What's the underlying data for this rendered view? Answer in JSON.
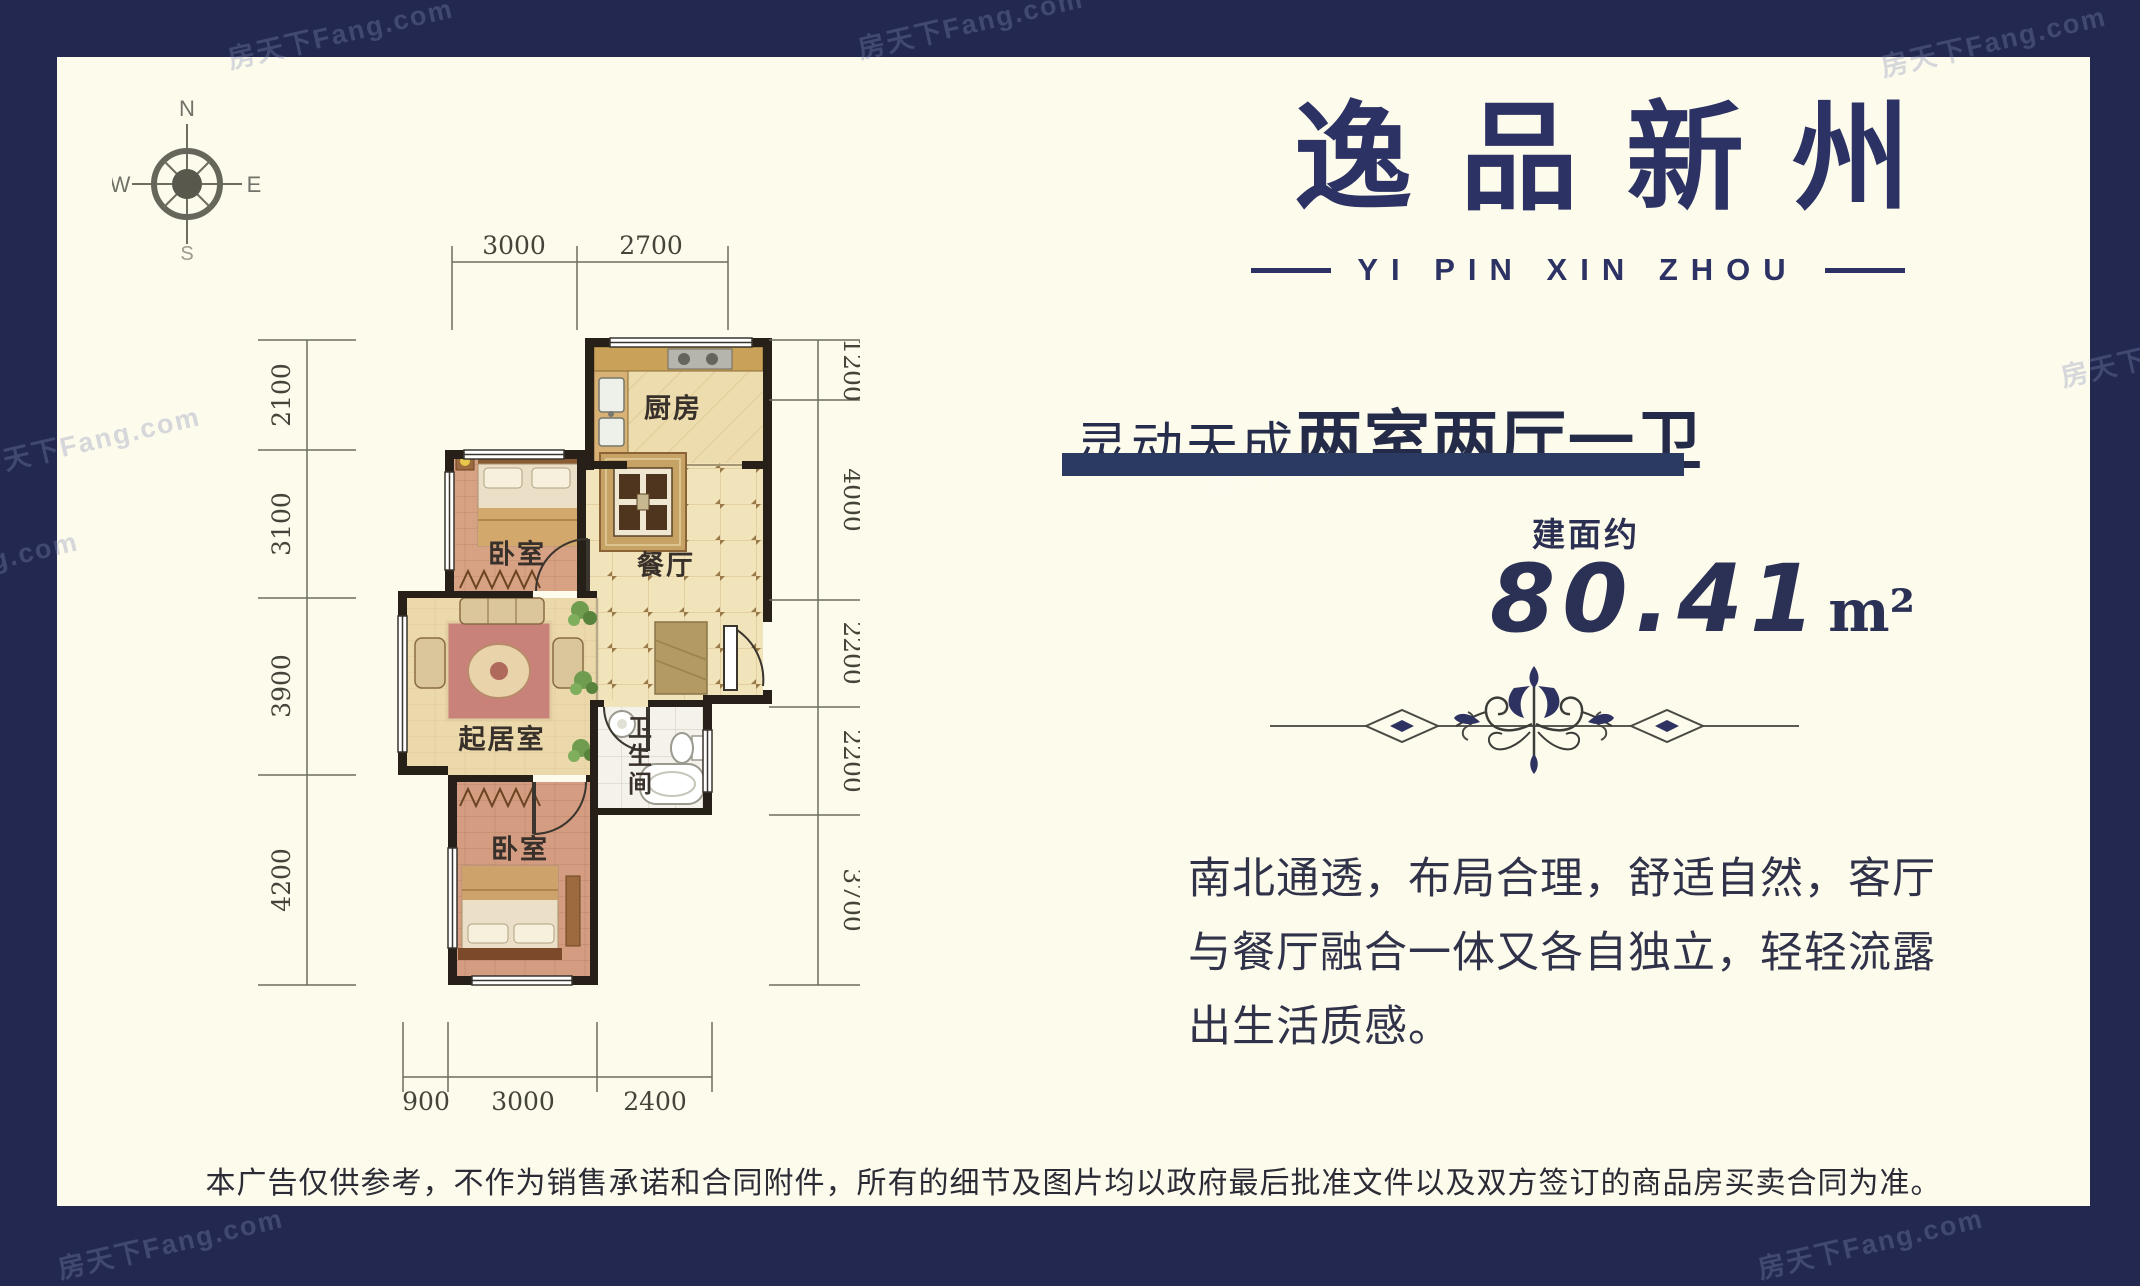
{
  "watermark": "房天下Fang.com",
  "brand": {
    "title": "逸品新州",
    "subtitle": "YI PIN XIN ZHOU"
  },
  "tagline": {
    "prefix": "灵动天成",
    "highlight": "两室两厅一卫"
  },
  "area": {
    "label": "建面约",
    "value": "80.41",
    "unit": "m²"
  },
  "description": {
    "lines": [
      "南北通透，布局合理，舒适自然，客厅",
      "与餐厅融合一体又各自独立，轻轻流露",
      "出生活质感。"
    ]
  },
  "disclaimer": "本广告仅供参考，不作为销售承诺和合同附件，所有的细节及图片均以政府最后批准文件以及双方签订的商品房买卖合同为准。",
  "compass": {
    "n": "N",
    "e": "E",
    "s": "S",
    "w": "W"
  },
  "floorplan": {
    "rooms": {
      "kitchen": "厨房",
      "dining": "餐厅",
      "bedroom1": "卧室",
      "living": "起居室",
      "bathroom": "卫生间",
      "bedroom2": "卧室"
    },
    "dims_top": [
      "3000",
      "2700"
    ],
    "dims_left": [
      "2100",
      "3100",
      "3900",
      "4200"
    ],
    "dims_right": [
      "1200",
      "4000",
      "2200",
      "2200",
      "3700"
    ],
    "dims_bottom": [
      "900",
      "3000",
      "2400"
    ]
  },
  "colors": {
    "frame": "#232850",
    "panel": "#fdfbec",
    "accent": "#2c3264",
    "bar": "#2a3a60"
  }
}
